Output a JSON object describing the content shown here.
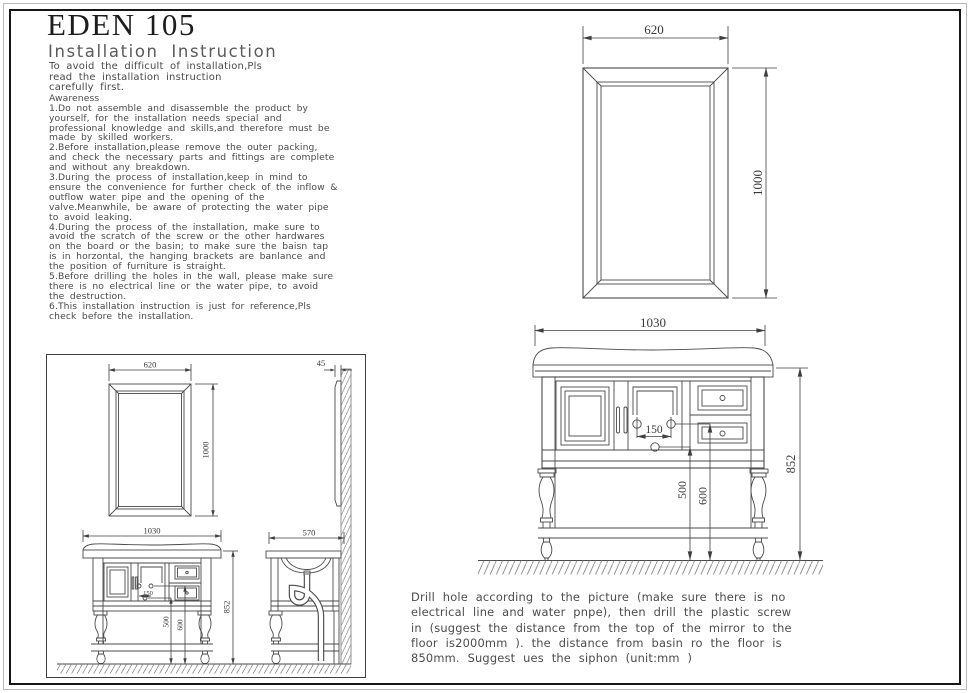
{
  "sheet": {
    "title": "EDEN 105",
    "subtitle": "Installation Instruction",
    "intro": [
      "To avoid the difficult of installation,Pls",
      "read the installation instruction",
      "carefully first."
    ],
    "awareness_label": "Awareness",
    "notes": [
      "1.Do not assemble and disassemble the product by",
      "yourself, for the installation needs special and",
      "professional knowledge and skills,and therefore must be",
      "made by skilled workers.",
      "2.Before installation,please remove the outer packing,",
      "and check the necessary parts and fittings are complete",
      "and without any breakdown.",
      "3.During the process of installation,keep in mind to",
      "ensure the convenience for further check of the inflow &",
      "outflow water pipe and the opening of the",
      "valve.Meanwhile, be aware of protecting the water pipe",
      "to avoid leaking.",
      "4.During the process of the installation, make sure to",
      "avoid the scratch of the screw or the other hardwares",
      "on the board or the basin; to make sure the baisn tap",
      "is in horzontal, the hanging brackets are banlance and",
      "the position of furniture is straight.",
      "5.Before drilling the holes in the wall, please make sure",
      "there is no electrical line or the water pipe, to avoid",
      "the destruction.",
      "6.This installation instruction is just for reference,Pls",
      "check before the installation."
    ],
    "footer": [
      "Drill hole according to the picture (make sure there is no",
      "electrical line and water pnpe), then drill the plastic screw",
      "in (suggest the distance from the top of the mirror to the",
      "floor is2000mm ). the distance from basin ro the floor is",
      "850mm. Suggest ues the siphon (unit:mm )"
    ]
  },
  "drawings": {
    "colors": {
      "line": "#4a4a4a",
      "dimension": "#3f3f3f",
      "border": "#161616"
    },
    "mirror_front": {
      "width_label": "620",
      "height_label": "1000"
    },
    "vanity_front": {
      "width_label": "1030",
      "height_label": "852",
      "hole_spacing_label": "150",
      "lower_hole_height_label": "500",
      "upper_hole_height_label": "600"
    },
    "installed_views": {
      "mirror_width_label": "620",
      "mirror_height_label": "1000",
      "mirror_depth_label": "45",
      "vanity_width_label": "1030",
      "vanity_height_label": "852",
      "side_depth_label": "570",
      "hole_spacing_label": "150",
      "lower_hole_height_label": "500",
      "upper_hole_height_label": "600"
    }
  }
}
